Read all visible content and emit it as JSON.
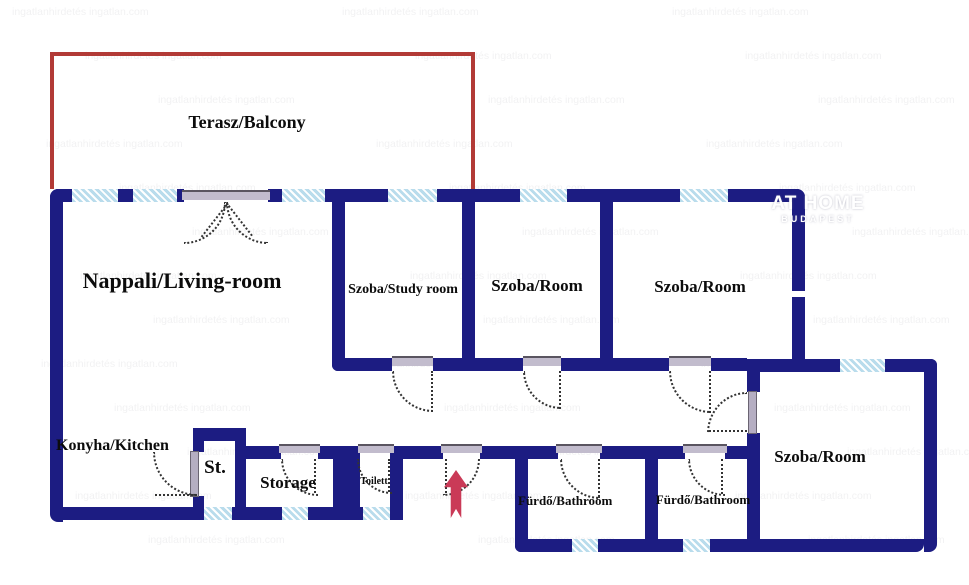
{
  "title": "Apartment floor plan",
  "colors": {
    "wall": "#1c1c82",
    "window": "#b9dcec",
    "red_outline": "#b23a36",
    "arrow": "#ca3a57",
    "threshold": "#c2bccd",
    "door_leaf": "#b5aec2",
    "arc": "#333333",
    "label": "#0c0c0c"
  },
  "rooms": {
    "terasz": {
      "label": "Terasz/Balcony"
    },
    "nappali": {
      "label": "Nappali/Living-room"
    },
    "study": {
      "label": "Szoba/Study room"
    },
    "szoba1": {
      "label": "Szoba/Room"
    },
    "szoba2": {
      "label": "Szoba/Room"
    },
    "szoba3": {
      "label": "Szoba/Room"
    },
    "konyha": {
      "label": "Konyha/Kitchen"
    },
    "st": {
      "label": "St."
    },
    "storage": {
      "label": "Storage"
    },
    "toilett": {
      "label": "Toilett"
    },
    "furdo1": {
      "label": "Fürdő/Bathroom"
    },
    "furdo2": {
      "label": "Fürdő/Bathroom"
    }
  },
  "logo": {
    "line1": "AT HOME",
    "line2": "BUDAPEST"
  },
  "watermark": {
    "text": "ingatlanhirdetés ingatlan.com"
  }
}
